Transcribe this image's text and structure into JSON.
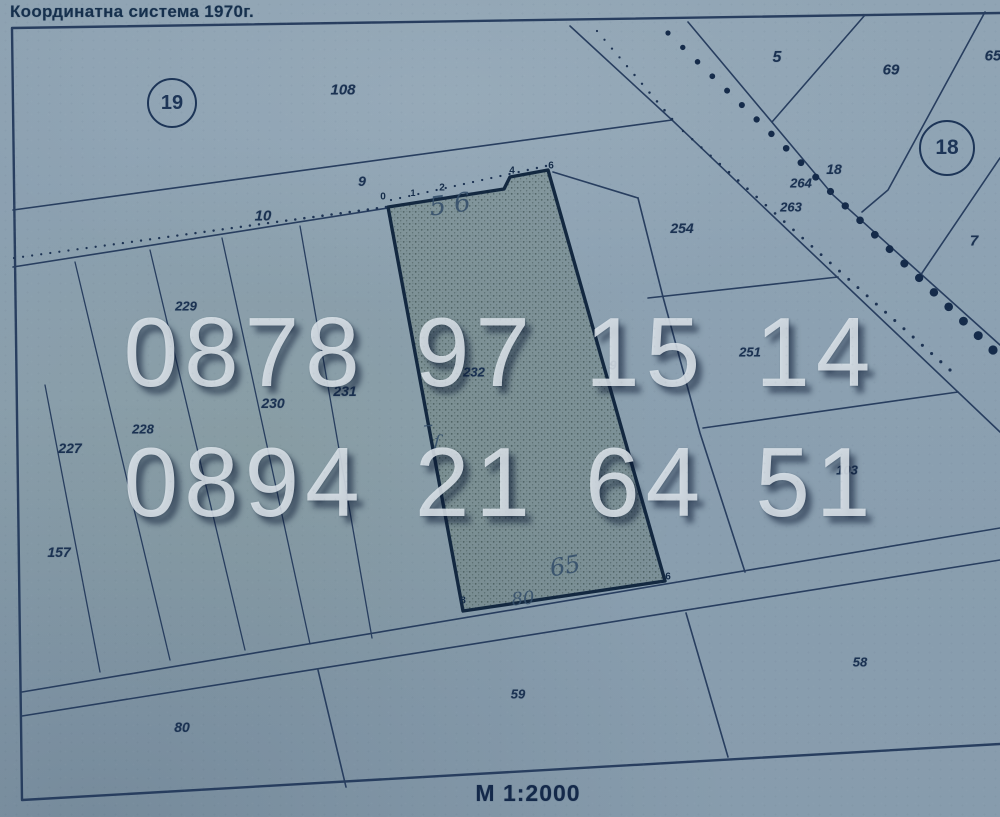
{
  "title": "Координатна система 1970г.",
  "scale_label": "М 1:2000",
  "watermark": {
    "phone1": "0878 97 15 14",
    "phone2": "0894 21 64 51"
  },
  "colors": {
    "paper": "#8ca1b2",
    "line": "#22385a",
    "label": "#1b3252",
    "watermark_text": "#e0e8ed",
    "highlight_parcel_fill": "#77897f"
  },
  "sheet_circles": [
    {
      "name": "sheet-number-19",
      "text": "19",
      "x": 172,
      "y": 103,
      "d": 46,
      "fs": 20
    },
    {
      "name": "sheet-number-18",
      "text": "18",
      "x": 947,
      "y": 148,
      "d": 52,
      "fs": 21
    }
  ],
  "parcel_labels": [
    {
      "name": "parcel-label-108",
      "text": "108",
      "x": 343,
      "y": 90,
      "fs": 15
    },
    {
      "name": "parcel-label-5",
      "text": "5",
      "x": 777,
      "y": 58,
      "fs": 16
    },
    {
      "name": "parcel-label-69",
      "text": "69",
      "x": 891,
      "y": 70,
      "fs": 15
    },
    {
      "name": "parcel-label-65",
      "text": "65",
      "x": 993,
      "y": 56,
      "fs": 15
    },
    {
      "name": "parcel-label-264",
      "text": "264",
      "x": 801,
      "y": 183,
      "fs": 13
    },
    {
      "name": "parcel-label-18",
      "text": "18",
      "x": 834,
      "y": 169,
      "fs": 14
    },
    {
      "name": "parcel-label-263",
      "text": "263",
      "x": 791,
      "y": 207,
      "fs": 13
    },
    {
      "name": "parcel-label-7",
      "text": "7",
      "x": 974,
      "y": 241,
      "fs": 15
    },
    {
      "name": "parcel-label-254",
      "text": "254",
      "x": 682,
      "y": 228,
      "fs": 14
    },
    {
      "name": "parcel-label-251",
      "text": "251",
      "x": 750,
      "y": 352,
      "fs": 13
    },
    {
      "name": "parcel-label-9-strip",
      "text": "9",
      "x": 613,
      "y": 365,
      "fs": 13
    },
    {
      "name": "parcel-label-103",
      "text": "103",
      "x": 847,
      "y": 470,
      "fs": 13
    },
    {
      "name": "road-label-9",
      "text": "9",
      "x": 362,
      "y": 181,
      "fs": 14
    },
    {
      "name": "road-label-10",
      "text": "10",
      "x": 263,
      "y": 216,
      "fs": 15
    },
    {
      "name": "parcel-label-227",
      "text": "227",
      "x": 70,
      "y": 448,
      "fs": 14
    },
    {
      "name": "parcel-label-228",
      "text": "228",
      "x": 143,
      "y": 429,
      "fs": 13
    },
    {
      "name": "parcel-label-229",
      "text": "229",
      "x": 186,
      "y": 306,
      "fs": 13
    },
    {
      "name": "parcel-label-230",
      "text": "230",
      "x": 273,
      "y": 403,
      "fs": 14
    },
    {
      "name": "parcel-label-231",
      "text": "231",
      "x": 345,
      "y": 391,
      "fs": 14
    },
    {
      "name": "parcel-label-232",
      "text": "232",
      "x": 474,
      "y": 372,
      "fs": 13
    },
    {
      "name": "parcel-label-157",
      "text": "157",
      "x": 59,
      "y": 552,
      "fs": 14
    },
    {
      "name": "parcel-label-80",
      "text": "80",
      "x": 182,
      "y": 727,
      "fs": 14
    },
    {
      "name": "parcel-label-59",
      "text": "59",
      "x": 518,
      "y": 694,
      "fs": 13
    },
    {
      "name": "parcel-label-58",
      "text": "58",
      "x": 860,
      "y": 662,
      "fs": 13
    }
  ],
  "vertex_labels": [
    {
      "name": "vertex-0",
      "text": "0",
      "x": 383,
      "y": 197,
      "fs": 10
    },
    {
      "name": "vertex-1",
      "text": "1",
      "x": 413,
      "y": 193,
      "fs": 9
    },
    {
      "name": "vertex-2",
      "text": "2",
      "x": 442,
      "y": 188,
      "fs": 10
    },
    {
      "name": "vertex-4",
      "text": "4",
      "x": 512,
      "y": 171,
      "fs": 10
    },
    {
      "name": "vertex-6-top",
      "text": "6",
      "x": 551,
      "y": 166,
      "fs": 10
    },
    {
      "name": "vertex-8",
      "text": "8",
      "x": 463,
      "y": 601,
      "fs": 10
    },
    {
      "name": "vertex-6-bottom",
      "text": "6",
      "x": 668,
      "y": 577,
      "fs": 10
    }
  ],
  "handwritten_notes": [
    {
      "name": "handwriting-56",
      "text": "5 6",
      "x": 450,
      "y": 205,
      "fs": 26,
      "rot": -8
    },
    {
      "name": "handwriting-dash",
      "text": "–",
      "x": 428,
      "y": 424,
      "fs": 20,
      "rot": -5
    },
    {
      "name": "handwriting-curl",
      "text": "ſ",
      "x": 437,
      "y": 442,
      "fs": 17,
      "rot": 4
    },
    {
      "name": "handwriting-65",
      "text": "65",
      "x": 565,
      "y": 566,
      "fs": 24,
      "rot": -10
    },
    {
      "name": "handwriting-80",
      "text": "80",
      "x": 523,
      "y": 599,
      "fs": 18,
      "rot": -6
    }
  ]
}
